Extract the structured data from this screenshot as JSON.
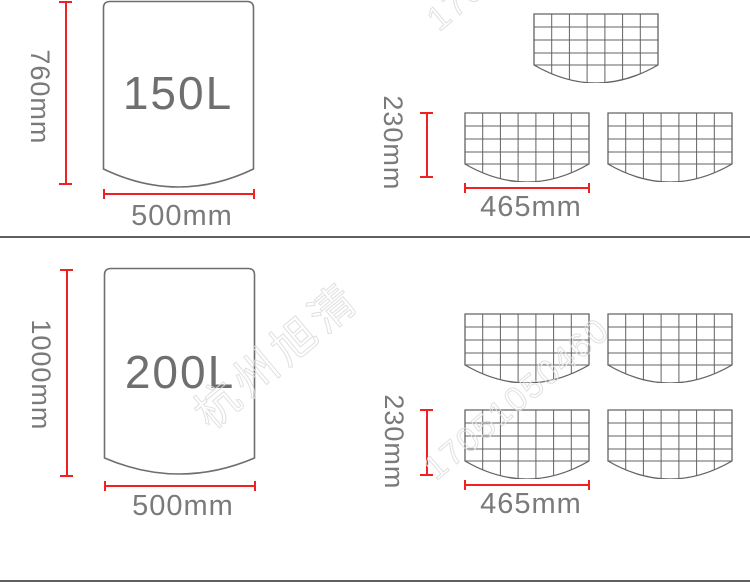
{
  "top_section": {
    "container": {
      "volume": "150L",
      "height_dim": "760mm",
      "width_dim": "500mm"
    },
    "grid_panels": {
      "height_dim": "230mm",
      "width_dim": "465mm"
    }
  },
  "bottom_section": {
    "container": {
      "volume": "200L",
      "height_dim": "1000mm",
      "width_dim": "500mm"
    },
    "grid_panels": {
      "height_dim": "230mm",
      "width_dim": "465mm"
    }
  },
  "watermark": {
    "brand": "杭州旭清",
    "phone": "17051050460"
  },
  "colors": {
    "dimension_red": "#f02121",
    "shape_gray": "#6e6e6e",
    "grid_gray": "#636363",
    "text_gray": "#7a7a7a",
    "divider_gray": "#606060",
    "watermark_gray": "#dddddd"
  }
}
